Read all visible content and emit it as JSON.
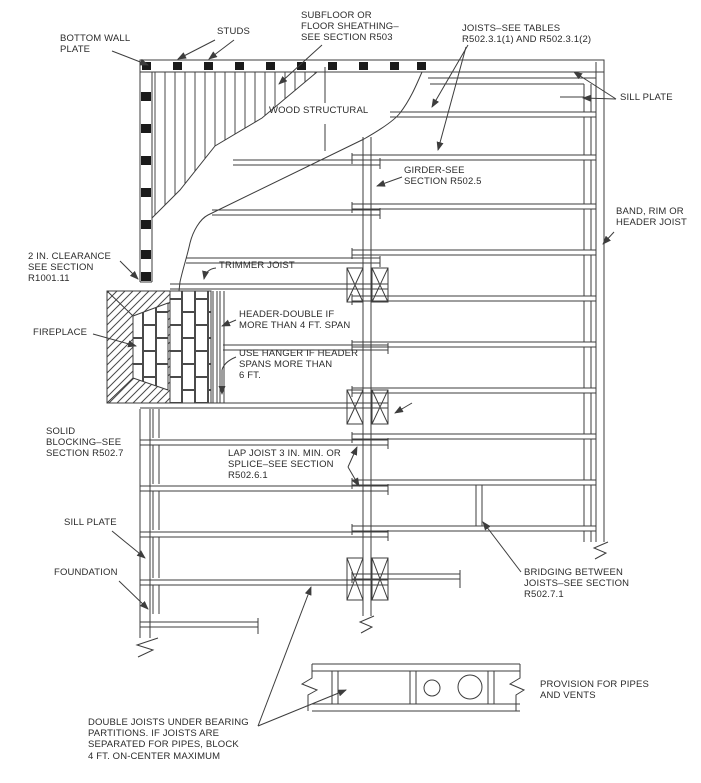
{
  "title": "Floor framing construction diagram",
  "colors": {
    "line": "#3d3d3d",
    "text": "#2b2b2b",
    "background": "#ffffff",
    "stud_fill": "#1a1a1a"
  },
  "labels": {
    "bottom_wall_plate": "BOTTOM WALL\nPLATE",
    "studs": "STUDS",
    "subfloor": "SUBFLOOR OR\nFLOOR SHEATHING–\nSEE SECTION R503",
    "joists": "JOISTS–SEE TABLES\nR502.3.1(1) AND R502.3.1(2)",
    "sill_plate_top": "SILL PLATE",
    "wood_structural": "WOOD STRUCTURAL",
    "girder": "GIRDER-SEE\nSECTION R502.5",
    "band_rim": "BAND, RIM OR\nHEADER JOIST",
    "clearance": "2 IN. CLEARANCE\nSEE SECTION\nR1001.11",
    "trimmer_joist": "TRIMMER JOIST",
    "header_double": "HEADER-DOUBLE IF\nMORE THAN 4 FT. SPAN",
    "use_hanger": "USE HANGER IF HEADER\nSPANS MORE THAN\n6 FT.",
    "fireplace": "FIREPLACE",
    "solid_blocking": "SOLID\nBLOCKING–SEE\nSECTION R502.7",
    "lap_joist": "LAP JOIST 3 IN. MIN. OR\nSPLICE–SEE SECTION\nR502.6.1",
    "sill_plate_bottom": "SILL PLATE",
    "foundation": "FOUNDATION",
    "bridging": "BRIDGING BETWEEN\nJOISTS–SEE SECTION\nR502.7.1",
    "provision": "PROVISION FOR PIPES\nAND VENTS",
    "double_joists": "DOUBLE JOISTS UNDER BEARING\nPARTITIONS. IF JOISTS ARE\nSEPARATED FOR PIPES, BLOCK\n4 FT. ON-CENTER MAXIMUM"
  }
}
